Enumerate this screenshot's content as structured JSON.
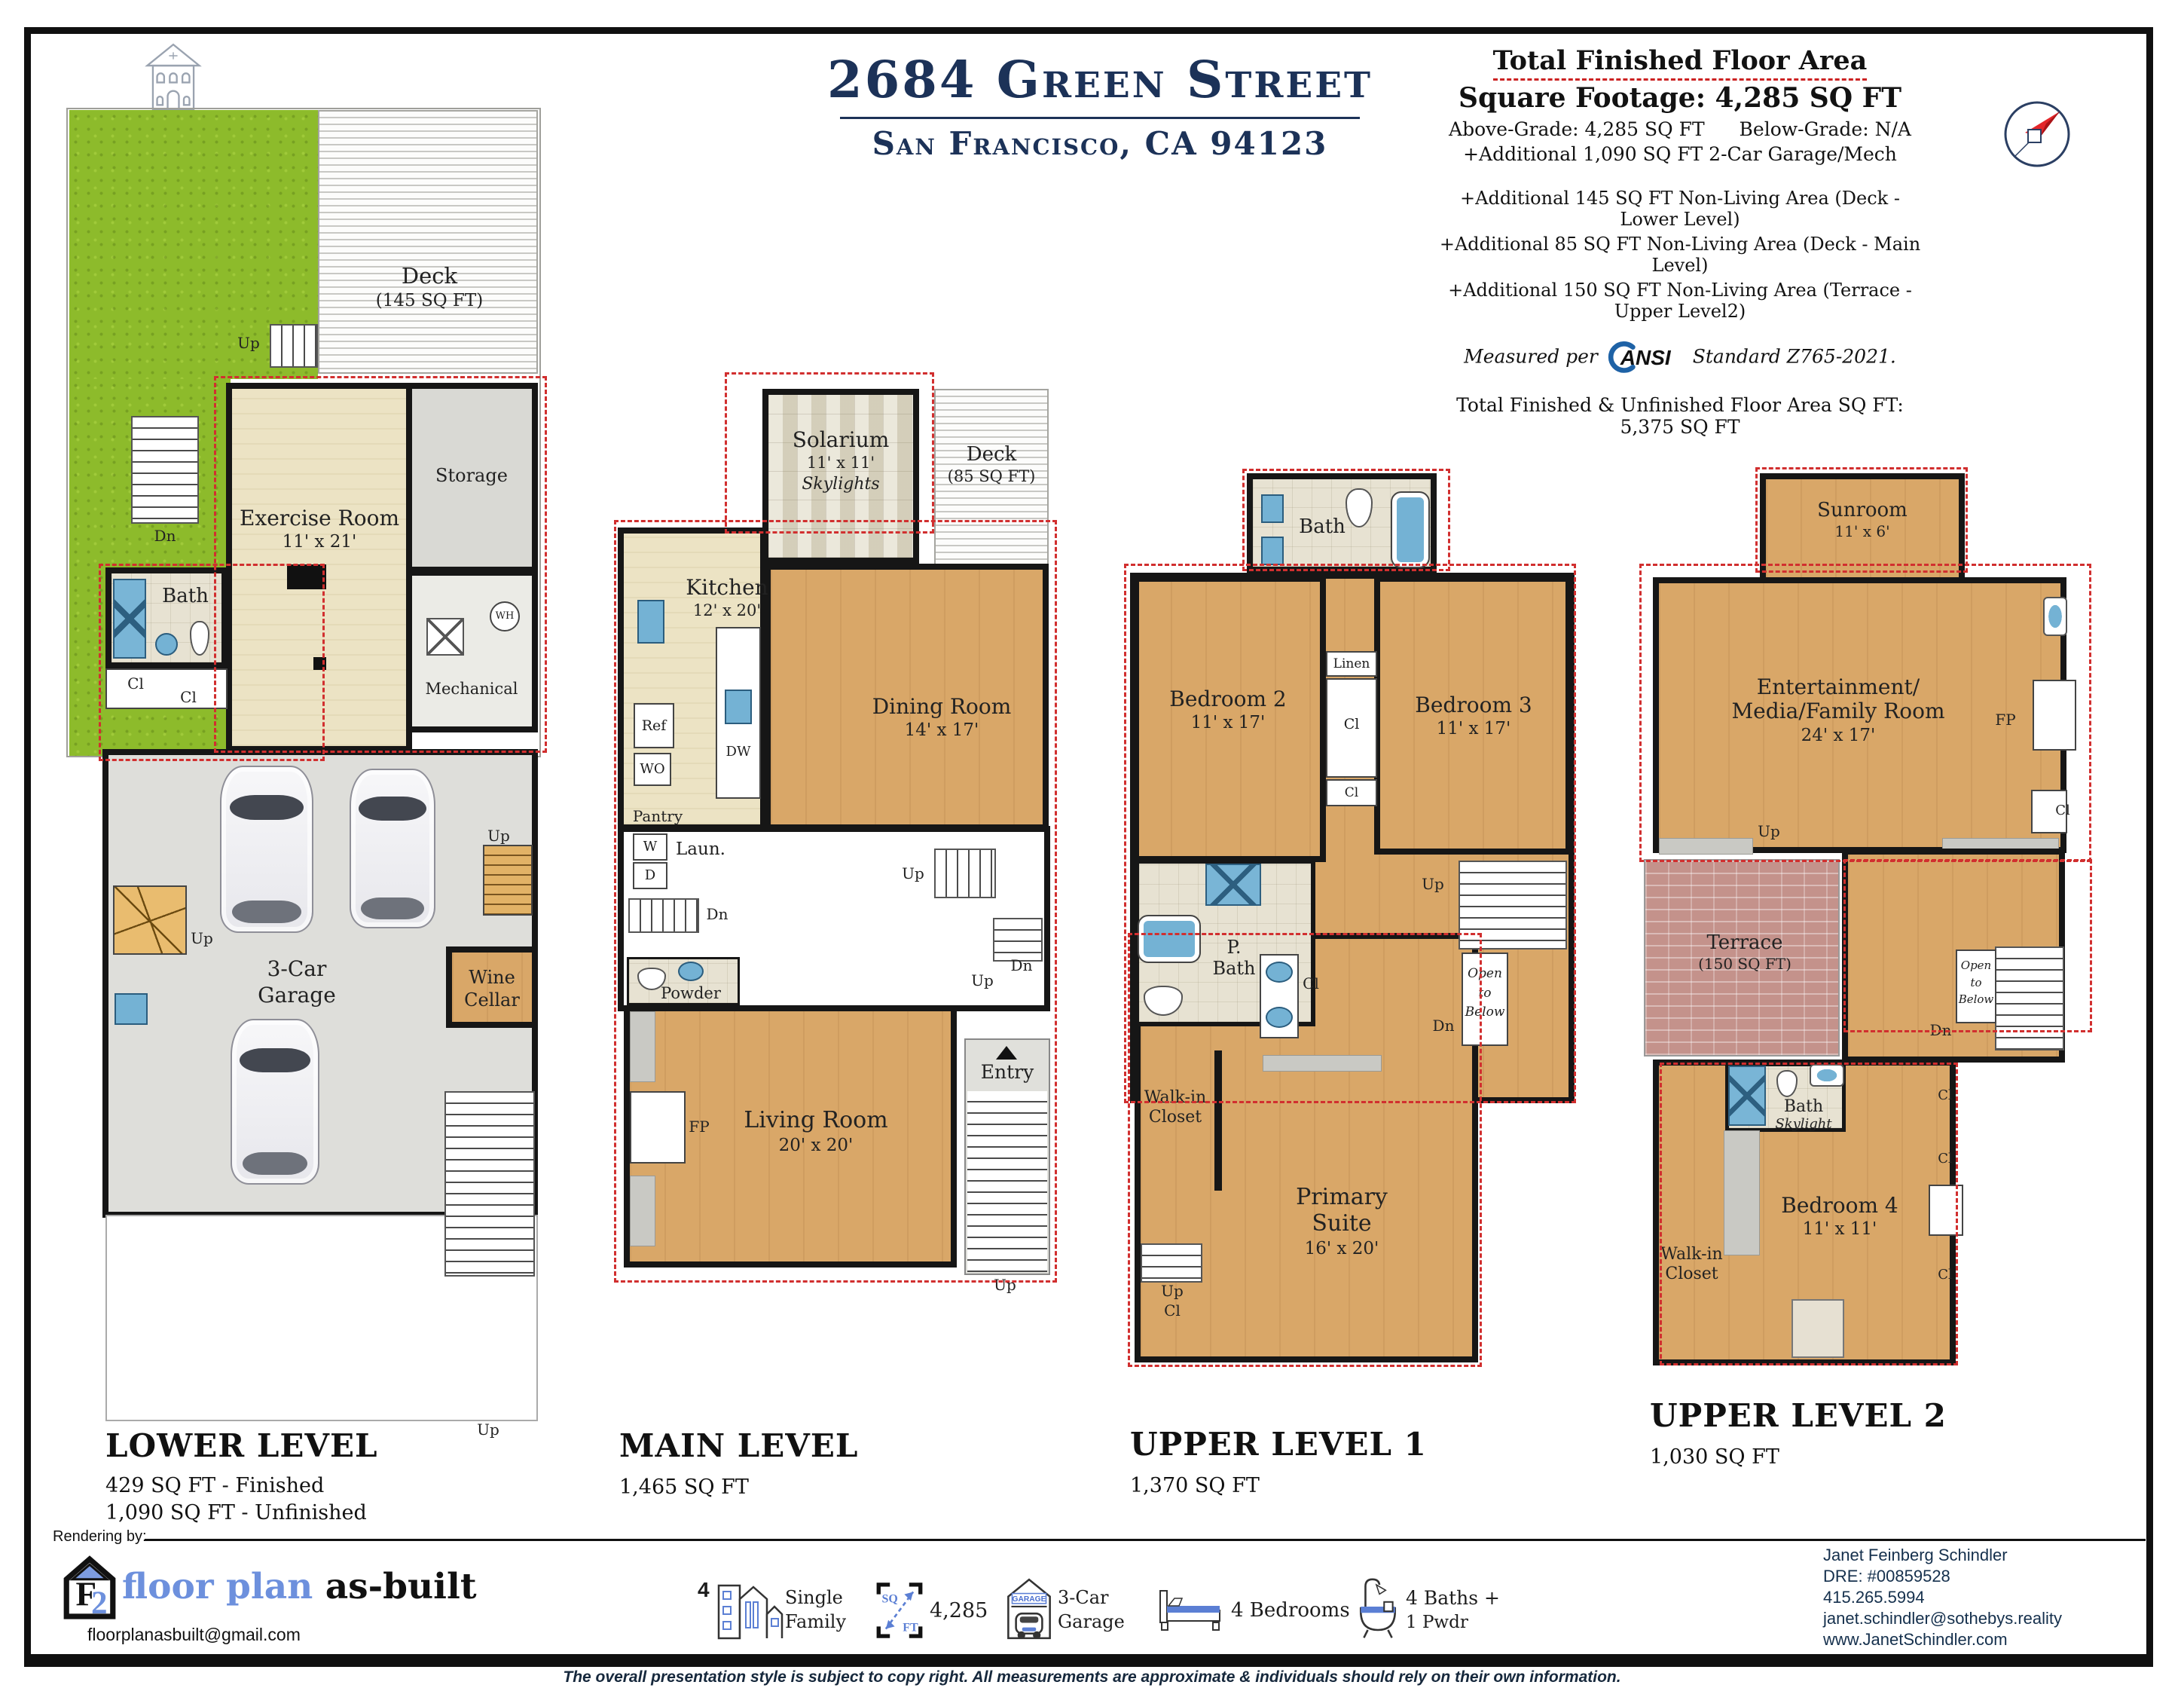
{
  "header": {
    "logo": {
      "name": "SCHINDLER",
      "sub": "HOMES"
    },
    "title": "2684 Green Street",
    "subtitle": "San Francisco, CA 94123",
    "summary": {
      "title": "Total Finished Floor Area",
      "footage": "Square Footage: 4,285 SQ FT",
      "above": "Above-Grade: 4,285 SQ FT",
      "below": "Below-Grade: N/A",
      "add_garage": "+Additional  1,090 SQ FT 2-Car Garage/Mech",
      "add_deck_lower": "+Additional  145 SQ FT Non-Living Area (Deck - Lower Level)",
      "add_deck_main": "+Additional  85 SQ FT Non-Living Area (Deck - Main Level)",
      "add_terrace": "+Additional  150 SQ FT Non-Living Area (Terrace - Upper Level2)",
      "measured_pre": "Measured per",
      "ansi": "ANSI",
      "measured_post": "Standard Z765-2021.",
      "total": "Total Finished & Unfinished Floor Area SQ FT: 5,375 SQ FT"
    }
  },
  "glyph": {
    "up": "Up",
    "dn": "Dn",
    "cl": "Cl",
    "fp": "FP",
    "wh": "WH",
    "entry": "Entry",
    "open": "Open to Below",
    "linen": "Linen",
    "powder": "Powder",
    "pantry": "Pantry",
    "ref": "Ref",
    "wo": "WO",
    "dw": "DW",
    "w": "W",
    "d": "D",
    "laun": "Laun.",
    "bath": "Bath",
    "skylight": "Skylight",
    "storage": "Storage",
    "mech": "Mechanical",
    "walkin": "Walk-in Closet"
  },
  "plans": {
    "lower": {
      "title": "LOWER LEVEL",
      "sq1": "429 SQ FT - Finished",
      "sq2": "1,090 SQ FT - Unfinished",
      "deck": {
        "l": "Deck",
        "s": "(145 SQ FT)"
      },
      "exercise": {
        "l": "Exercise Room",
        "s": "11' x 21'"
      },
      "garage": {
        "l": "3-Car Garage"
      },
      "wine": {
        "l": "Wine Cellar"
      }
    },
    "main": {
      "title": "MAIN LEVEL",
      "sq1": "1,465 SQ FT",
      "solarium": {
        "l": "Solarium",
        "s": "11' x 11'",
        "n": "Skylights"
      },
      "deck": {
        "l": "Deck",
        "s": "(85 SQ FT)"
      },
      "kitchen": {
        "l": "Kitchen",
        "s": "12' x 20'"
      },
      "dining": {
        "l": "Dining Room",
        "s": "14' x 17'"
      },
      "living": {
        "l": "Living Room",
        "s": "20' x 20'"
      }
    },
    "upper1": {
      "title": "UPPER LEVEL 1",
      "sq1": "1,370 SQ FT",
      "bed2": {
        "l": "Bedroom 2",
        "s": "11' x 17'"
      },
      "bed3": {
        "l": "Bedroom 3",
        "s": "11' x 17'"
      },
      "pbath": {
        "l": "P. Bath"
      },
      "primary": {
        "l": "Primary Suite",
        "s": "16' x 20'"
      }
    },
    "upper2": {
      "title": "UPPER LEVEL 2",
      "sq1": "1,030 SQ FT",
      "sunroom": {
        "l": "Sunroom",
        "s": "11' x 6'"
      },
      "ent": {
        "l1": "Entertainment/",
        "l2": "Media/Family Room",
        "s": "24' x 17'"
      },
      "terrace": {
        "l": "Terrace",
        "s": "(150 SQ FT)"
      },
      "bed4": {
        "l": "Bedroom 4",
        "s": "11' x 11'"
      }
    }
  },
  "footer": {
    "rendering": "Rendering by:",
    "fpb": {
      "t1": "floor plan",
      "t2": "as-built",
      "email": "floorplanasbuilt@gmail.com"
    },
    "stats": {
      "units": {
        "v": "4",
        "l1": "Single",
        "l2": "Family"
      },
      "sqft": {
        "sq": "SQ",
        "ft": "FT",
        "v": "4,285"
      },
      "garage": {
        "tag": "GARAGE",
        "l1": "3-Car",
        "l2": "Garage"
      },
      "beds": {
        "l": "4 Bedrooms"
      },
      "baths": {
        "l1": "4 Baths +",
        "l2": "1 Pwdr"
      }
    },
    "contact": {
      "name": "Janet Feinberg Schindler",
      "dre": "DRE: #00859528",
      "phone": "415.265.5994",
      "email": "janet.schindler@sothebys.reality",
      "web": "www.JanetSchindler.com"
    },
    "disclaimer": "The overall presentation style is subject to copy right. All measurements are approximate & individuals should rely on their own information."
  }
}
